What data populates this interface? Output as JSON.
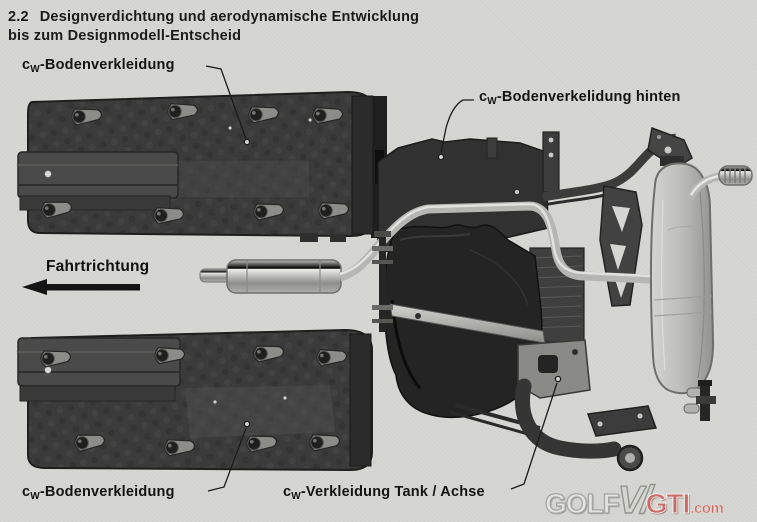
{
  "title": {
    "number": "2.2",
    "line1": "Designverdichtung und aerodynamische Entwicklung",
    "line2": "bis zum Designmodell-Entscheid"
  },
  "labels": {
    "underbody_panel_front_top": {
      "prefix": "c",
      "sub": "W",
      "rest": "-Bodenverkleidung"
    },
    "underbody_panel_rear": {
      "prefix": "c",
      "sub": "W",
      "rest": "-Bodenverkelidung hinten"
    },
    "driving_direction": "Fahrtrichtung",
    "underbody_panel_front_bottom": {
      "prefix": "c",
      "sub": "W",
      "rest": "-Bodenverkleidung"
    },
    "tank_axle_cover": {
      "prefix": "c",
      "sub": "W",
      "rest": "-Verkleidung Tank / Achse"
    }
  },
  "watermark": {
    "part1": "GOLF",
    "part2": "V/",
    "part3": "GTI",
    "part4": ".com"
  },
  "figure": {
    "parts": [
      "front-underbody-panel-top",
      "front-underbody-panel-bottom",
      "rear-underbody-panel",
      "center-muffler",
      "exhaust-pipe",
      "fuel-tank",
      "tank-strap",
      "rear-axle",
      "trailing-arm",
      "rear-muffler",
      "tailpipe",
      "direction-arrow"
    ]
  },
  "colors": {
    "paper": "#d6d6d2",
    "ink": "#1b1b1b",
    "panel_dark": "#3b3b3b",
    "tank_dark": "#242424",
    "metal_light": "#c9c9c5",
    "watermark_red": "#c96a66"
  }
}
